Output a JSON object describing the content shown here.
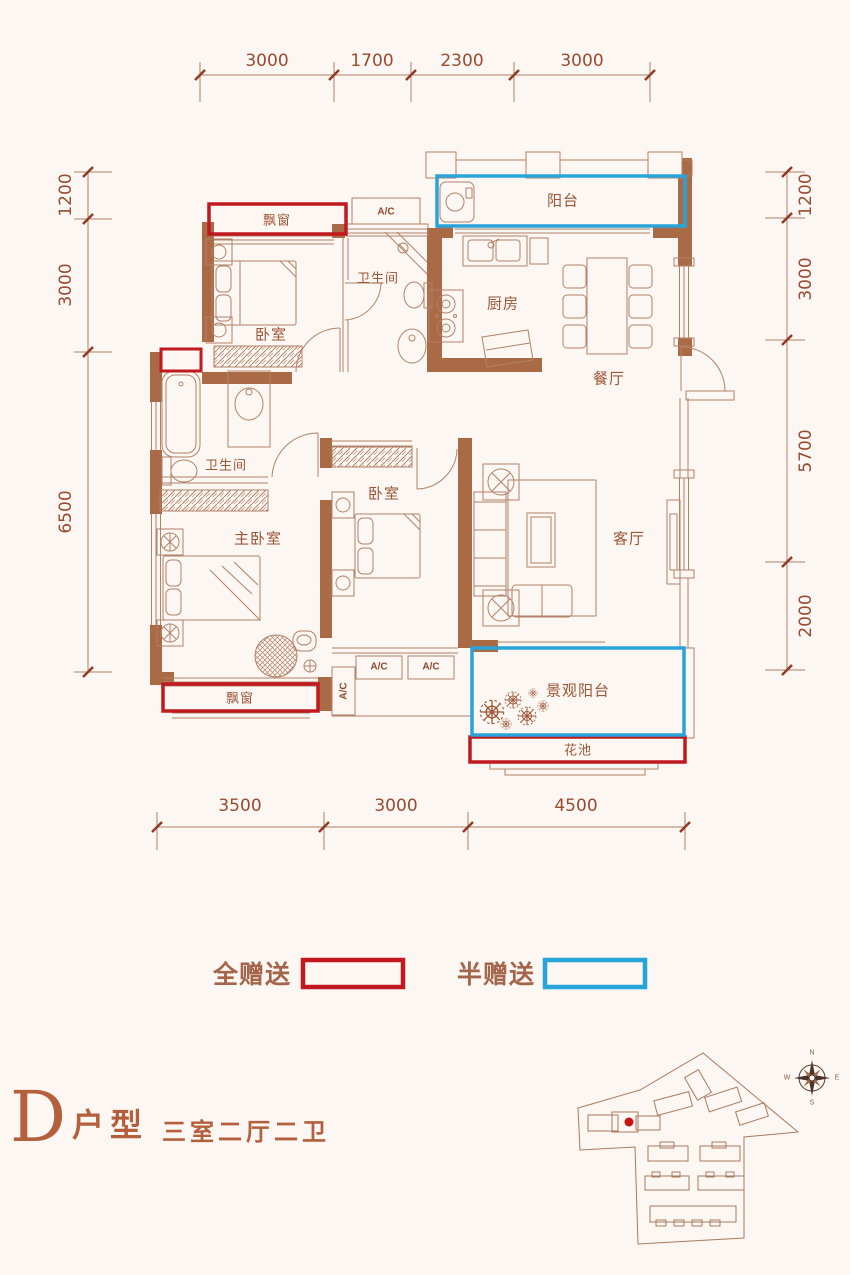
{
  "colors": {
    "wall": "#a96a45",
    "thin_line": "#b28268",
    "gift_full_red": "#c01920",
    "gift_half_blue": "#29a4da",
    "dimension_text": "#9a4a30",
    "title_accent": "#b4603c",
    "site_marker_red": "#cc1111"
  },
  "dimensions": {
    "top": [
      "3000",
      "1700",
      "2300",
      "3000"
    ],
    "bottom": [
      "3500",
      "3000",
      "4500"
    ],
    "left": [
      "1200",
      "3000",
      "6500"
    ],
    "right": [
      "1200",
      "3000",
      "5700",
      "2000"
    ]
  },
  "rooms": {
    "bay_window": "飘窗",
    "ac": "A/C",
    "balcony": "阳台",
    "bathroom": "卫生间",
    "kitchen": "厨房",
    "dining": "餐厅",
    "bedroom": "卧室",
    "master_bedroom": "主卧室",
    "living": "客厅",
    "scenic_balcony": "景观阳台",
    "flower_bed": "花池"
  },
  "legend": {
    "full_gift": "全赠送",
    "half_gift": "半赠送"
  },
  "title": {
    "letter": "D",
    "type_label": "户型",
    "spec": "三室二厅二卫"
  },
  "compass": {
    "north": "N",
    "east": "E",
    "south": "S",
    "west": "W"
  }
}
